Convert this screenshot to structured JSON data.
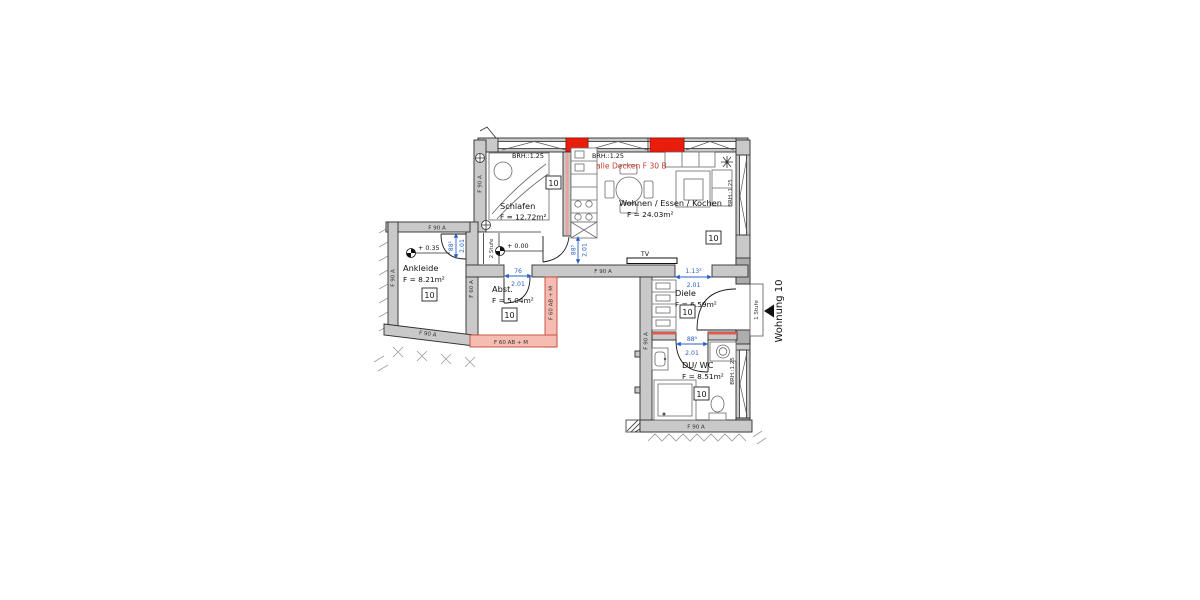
{
  "plan": {
    "unit_label": "10",
    "rooms": {
      "schlafen": {
        "name": "Schlafen",
        "area": "F = 12.72m²"
      },
      "wohnen": {
        "name": "Wohnen / Essen / Kochen",
        "area": "F = 24.03m²"
      },
      "ankleide": {
        "name": "Ankleide",
        "area": "F = 8.21m²"
      },
      "abstell": {
        "name": "Abst.",
        "area": "F = 5.04m²"
      },
      "diele": {
        "name": "Diele",
        "area": "F = 6.59m²"
      },
      "duwc": {
        "name": "DU/ WC",
        "area": "F = 8.51m²"
      }
    },
    "annotations": {
      "brh": "BRH.:1.25",
      "ceiling_note": "alle Decken F 30 B",
      "tv": "TV",
      "level_ankleide": "+ 0.35",
      "level_corridor": "+ 0.00",
      "steps_corridor": "2 Stufe",
      "steps_entrance": "1 Stufe",
      "apartment": "Wohnung 10"
    },
    "wall_labels": {
      "f90": "F 90 A",
      "f60": "F 60 A",
      "f60abm": "F 60 AB + M"
    },
    "dimensions": {
      "ankleide_door": {
        "w": "88¹",
        "h": "2.01"
      },
      "abst_door": {
        "w": "76",
        "h": "2.01"
      },
      "kitchen_door": {
        "w": "88⁵",
        "h": "2.01"
      },
      "diele_opening": {
        "w": "1.13³",
        "h": "2.01"
      },
      "duwc_door": {
        "w": "88⁵",
        "h": "2.01"
      }
    }
  },
  "colors": {
    "wall_gray": "#c9c9c9",
    "fire_wall_pink": "#f6bcb1",
    "accent_red": "#ea1d0c",
    "dim_blue": "#2a5fc4",
    "note_red": "#c23b2e"
  }
}
